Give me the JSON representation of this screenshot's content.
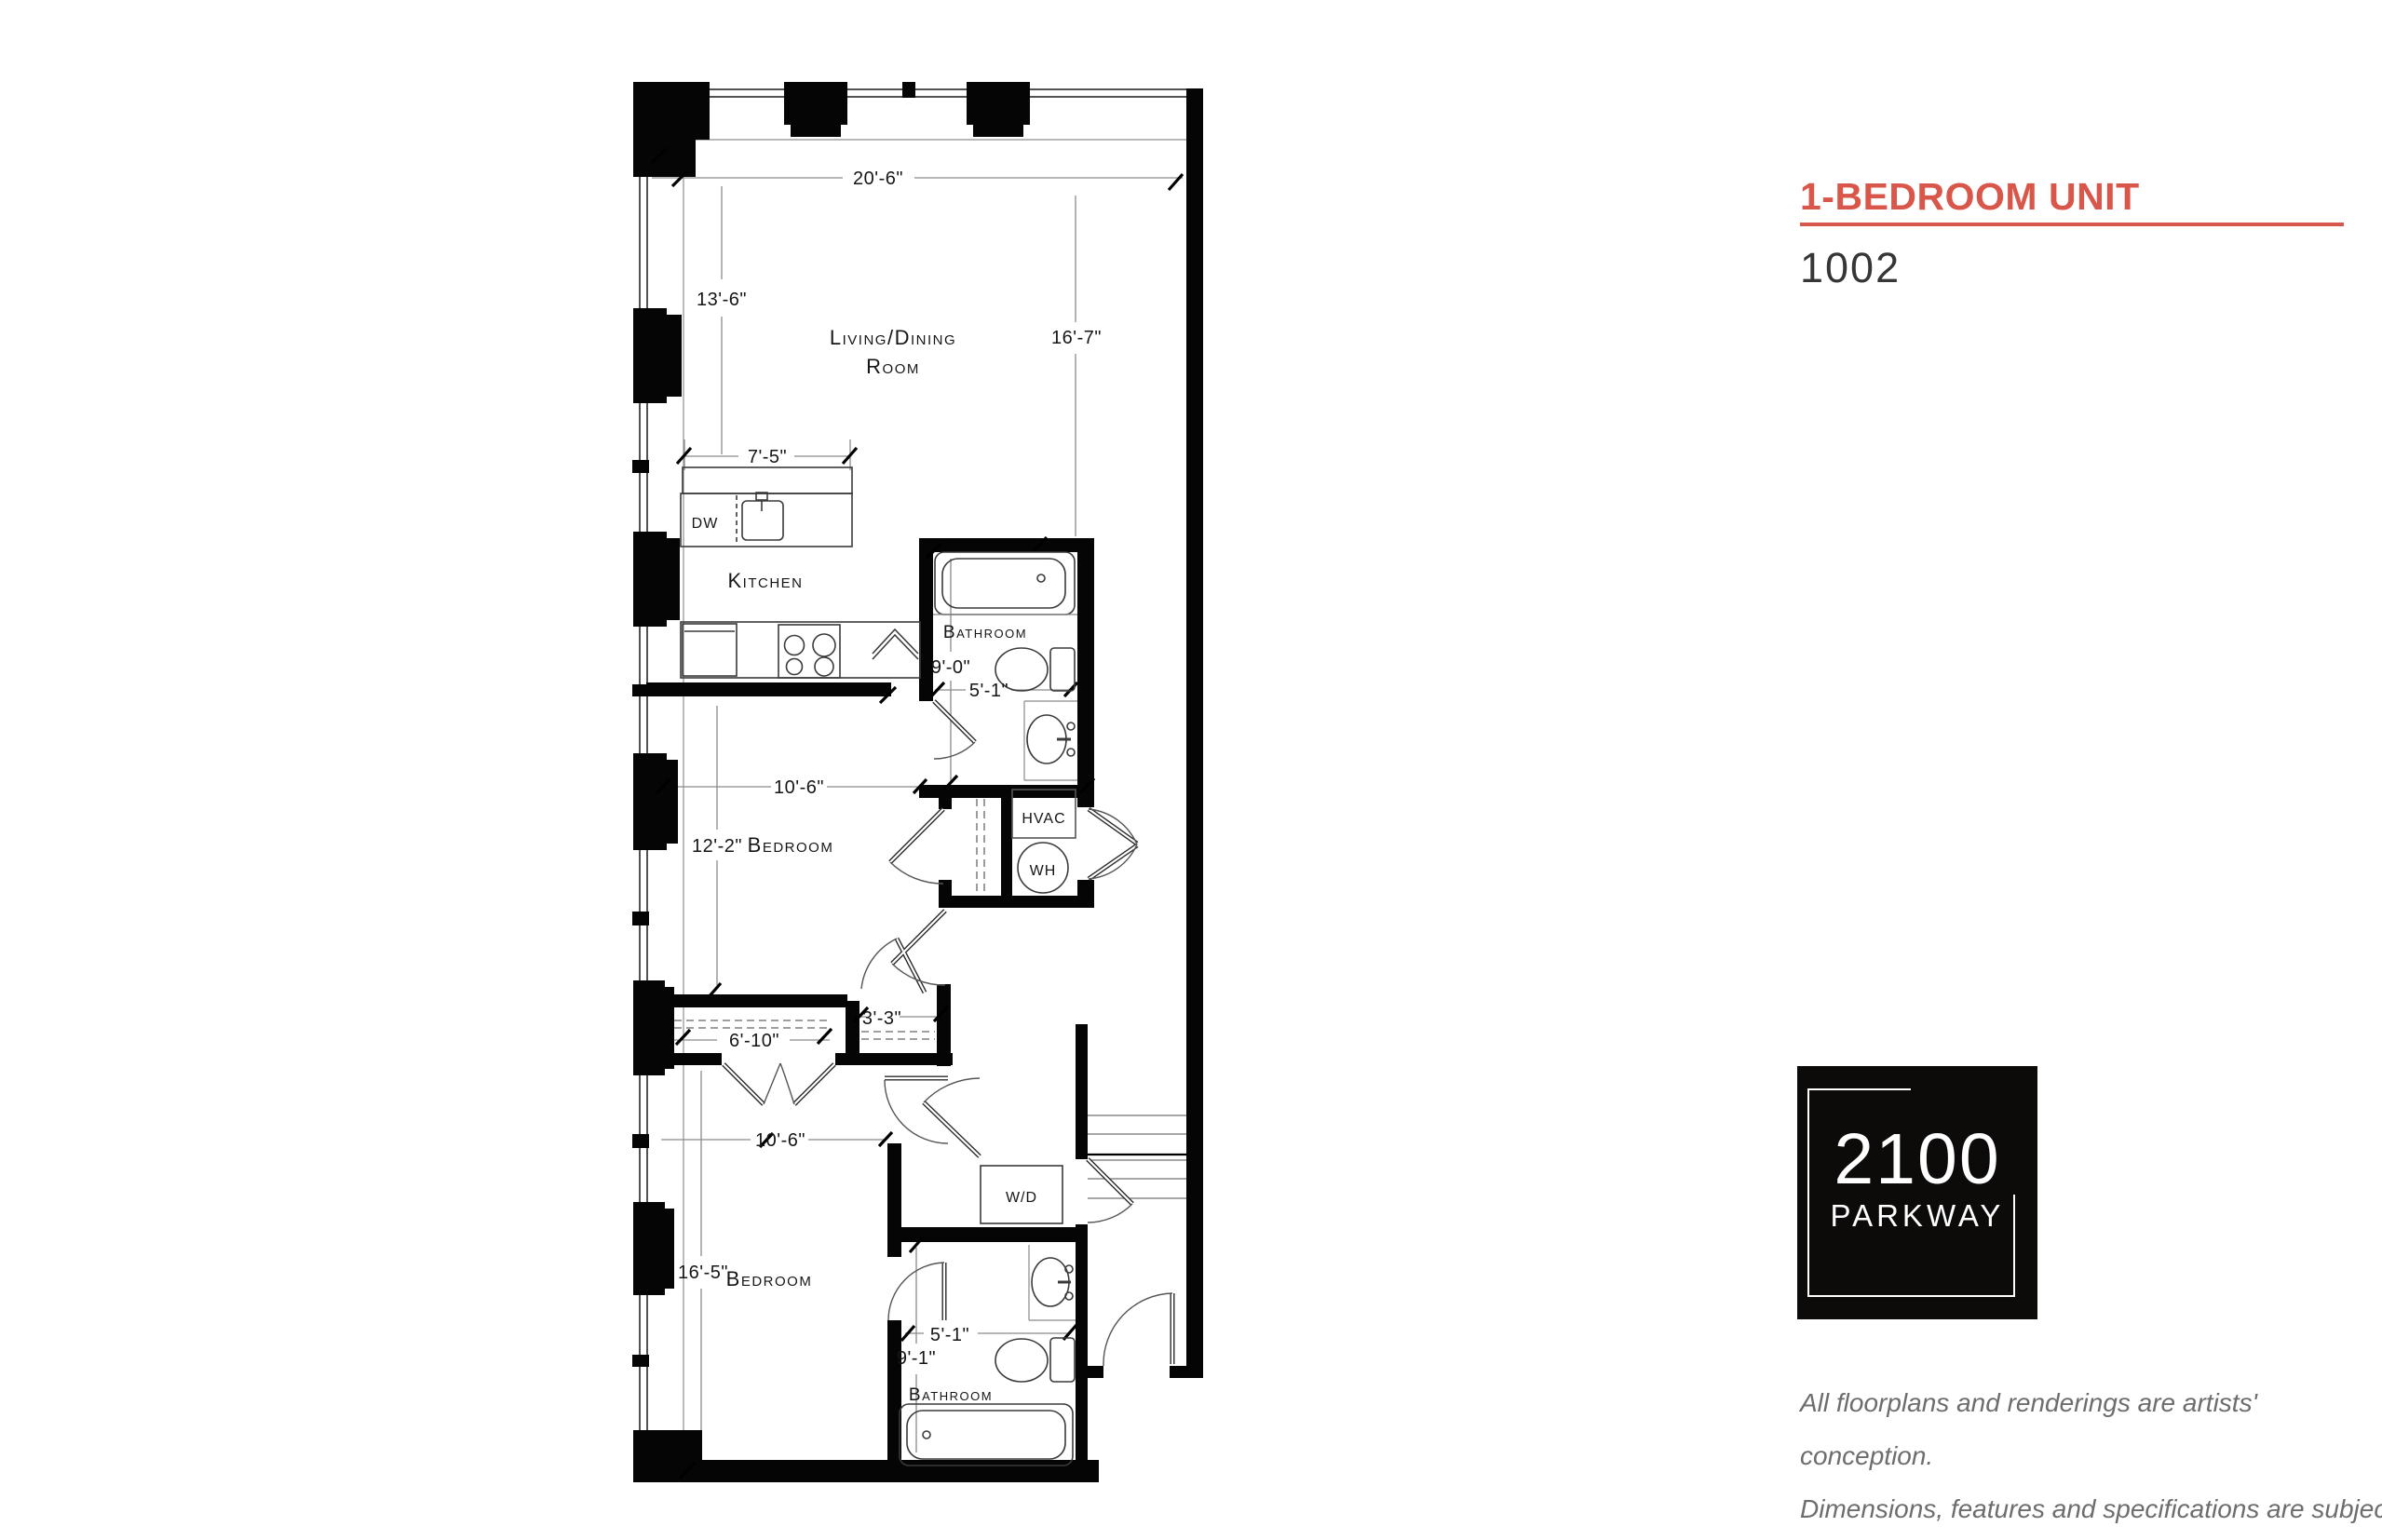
{
  "header": {
    "title": "1-BEDROOM UNIT",
    "unit_number": "1002",
    "accent_color": "#d9564a"
  },
  "floorplan": {
    "rooms": {
      "living_dining_line1": "Living/Dining",
      "living_dining_line2": "Room",
      "kitchen": "Kitchen",
      "bathroom_upper": "Bathroom",
      "bedroom_upper": "Bedroom",
      "bedroom_lower": "Bedroom",
      "bathroom_lower": "Bathroom"
    },
    "fixtures": {
      "dishwasher": "DW",
      "hvac": "HVAC",
      "water_heater": "WH",
      "washer_dryer": "W/D"
    },
    "dimensions": {
      "living_width": "20'-6\"",
      "living_height_left": "13'-6\"",
      "living_height_right": "16'-7\"",
      "kitchen_counter": "7'-5\"",
      "bathroom_upper_length": "9'-0\"",
      "bathroom_upper_width": "5'-1\"",
      "bedroom_upper_width": "10'-6\"",
      "bedroom_upper_depth": "12'-2\"",
      "closet_small": "3'-3\"",
      "closet_long": "6'-10\"",
      "bedroom_lower_width": "10'-6\"",
      "bedroom_lower_depth": "16'-5\"",
      "bathroom_lower_width": "5'-1\"",
      "bathroom_lower_length": "9'-1\""
    }
  },
  "logo": {
    "line1": "2100",
    "line2": "PARKWAY",
    "background_color": "#0d0a0a"
  },
  "disclaimer": {
    "line1": "All floorplans and renderings are artists' conception.",
    "line2": "Dimensions, features and specifications are subject",
    "line3": "to change at the discretion of the builder."
  }
}
